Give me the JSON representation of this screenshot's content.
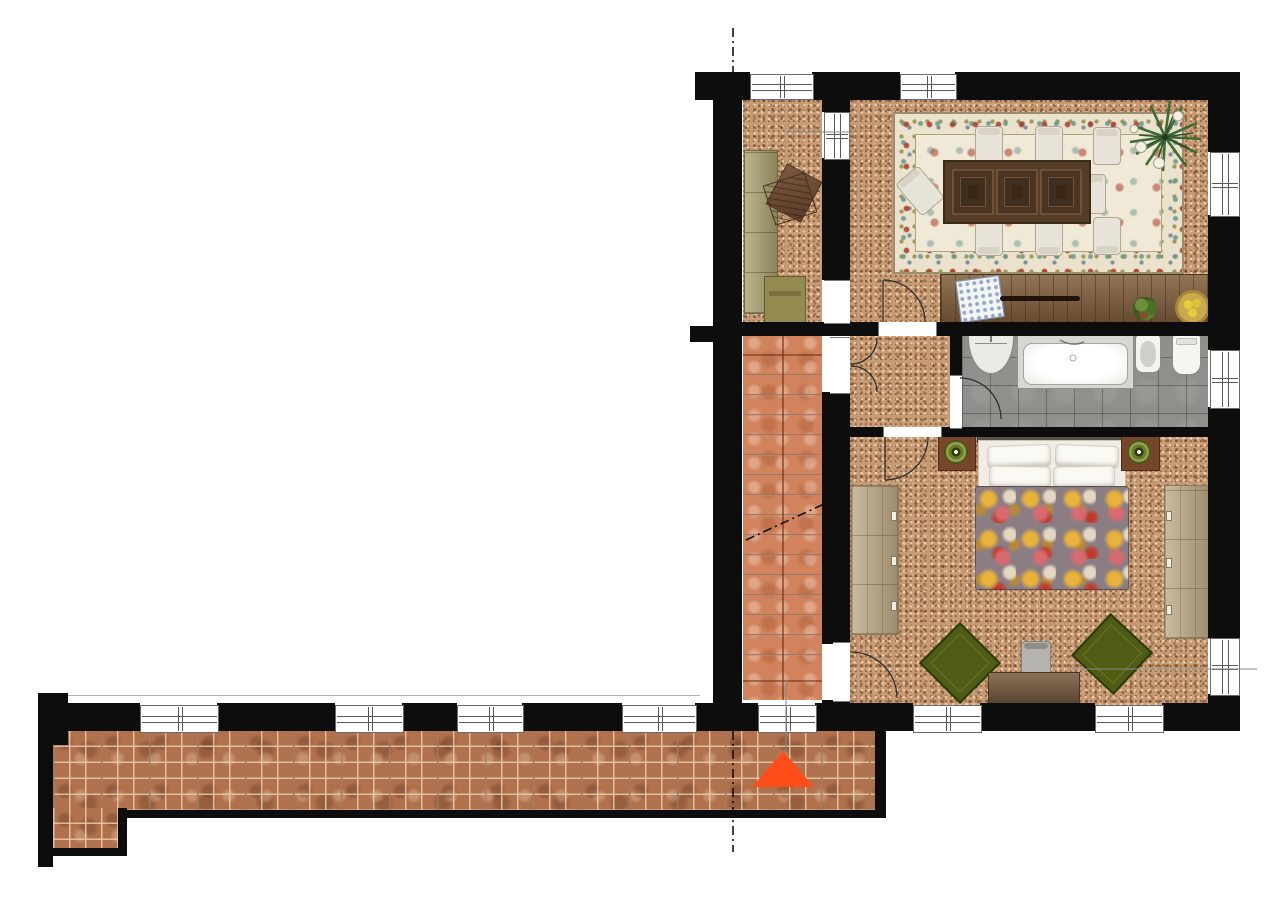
{
  "document": {
    "type": "architectural floor plan",
    "view": "top-down furnished plan"
  },
  "colors": {
    "wall": "#0d0d0d",
    "cork": "#c79a74",
    "terracotta": "#d0835c",
    "brick": "#b1714c",
    "bath_tile": "#8f8f8b",
    "marker": "#ff4d1a",
    "rug_base": "#eae2cc",
    "duvet": "#8b7d84",
    "armchair_green": "#4e5d13",
    "wood_dark": "#543b27",
    "wood_mid": "#7b5c3e",
    "wardrobe_tan": "#b8a787",
    "olive": "#a59b6e"
  },
  "rooms": [
    {
      "name": "entry-hall",
      "floor": "cork"
    },
    {
      "name": "living-dining-room",
      "floor": "cork"
    },
    {
      "name": "inner-hallway",
      "floor": "cork"
    },
    {
      "name": "bathroom",
      "floor": "gray-tile"
    },
    {
      "name": "bedroom",
      "floor": "cork"
    },
    {
      "name": "staircase",
      "floor": "terracotta-steps"
    },
    {
      "name": "balcony-corridor",
      "floor": "brick-tile"
    }
  ],
  "items": {
    "wall": "wall-segment",
    "window": "window-opening",
    "door": "door-swing",
    "closet": "hall-closet",
    "coat_stand": "coat-stand",
    "bench": "bench",
    "rug": "ornate-area-rug",
    "table": "dining-table",
    "chair": "dining-chair",
    "plant": "potted-plant",
    "sideboard": "sideboard",
    "tray": "decorative-tray",
    "handle": "drawer-pull",
    "green_plant": "small-plant",
    "fruit_bowl": "fruit-bowl",
    "sink": "washbasin",
    "tub": "bathtub",
    "bidet": "bidet",
    "toilet": "toilet",
    "headboard": "bed-headboard",
    "bed": "double-bed",
    "pillow": "pillow",
    "duvet": "floral-duvet",
    "nightstand": "nightstand",
    "lamp": "table-lamp",
    "wardrobe": "wardrobe",
    "armchair": "lounge-armchair",
    "desk": "desk",
    "desk_chair": "desk-chair",
    "stairs": "staircase-run",
    "marker": "entrance-direction-marker",
    "section_line": "section-cut-line",
    "leader": "reference-leader-line"
  }
}
